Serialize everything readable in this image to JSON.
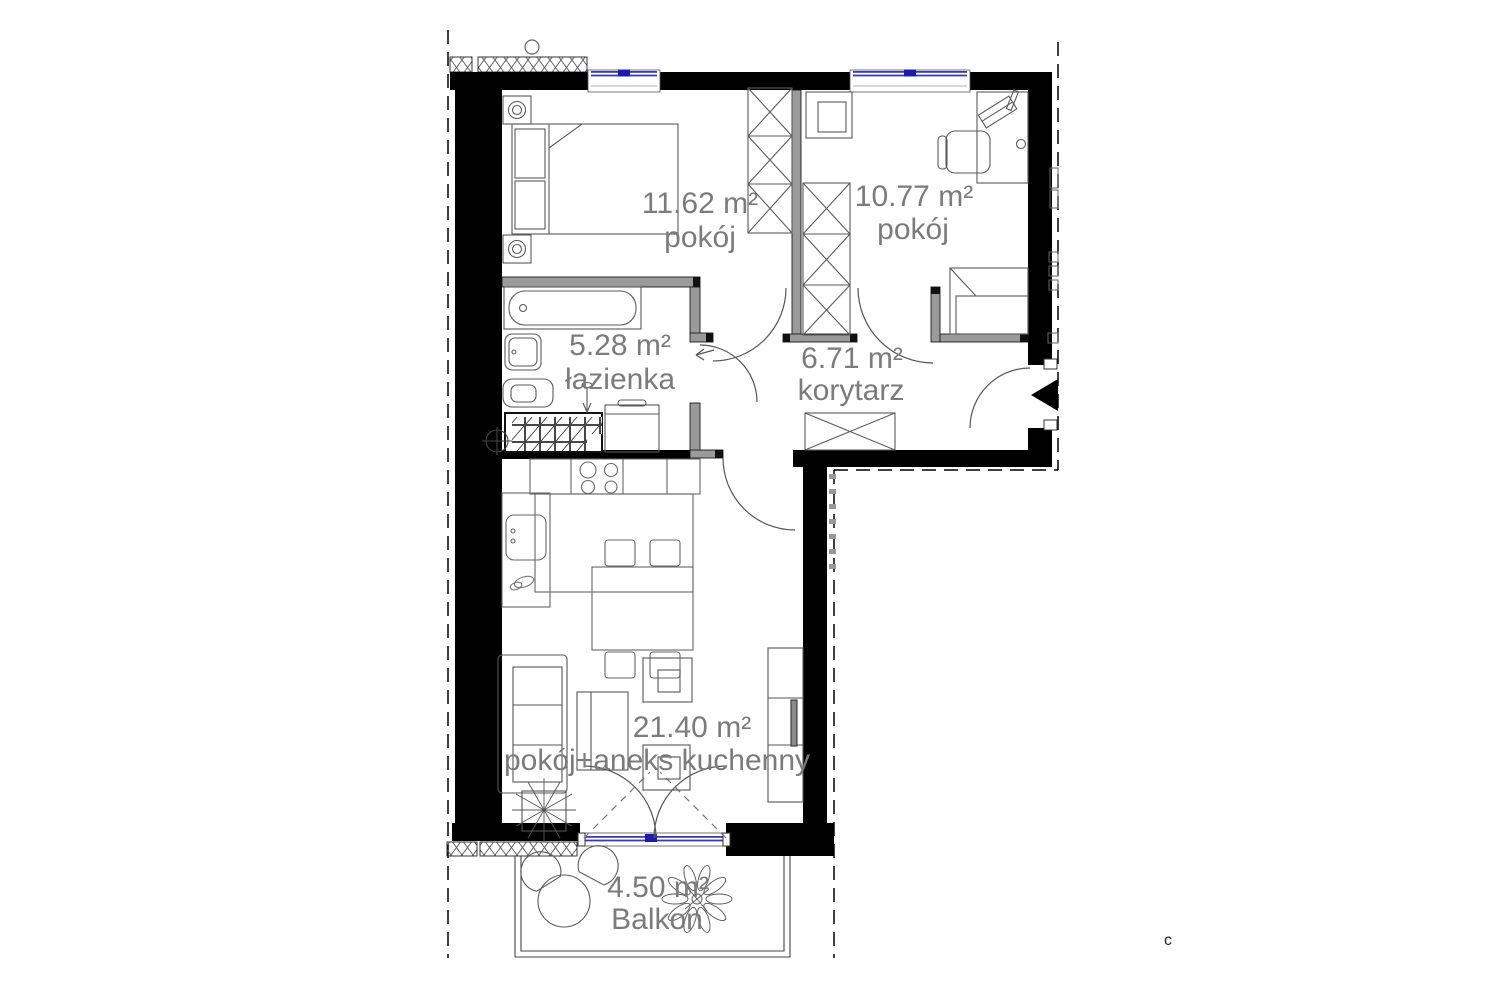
{
  "plan": {
    "type": "apartment-floor-plan",
    "rooms": {
      "bedroom": {
        "area": "11.62 m²",
        "name": "pokój"
      },
      "office": {
        "area": "10.77 m²",
        "name": "pokój"
      },
      "bathroom": {
        "area": "5.28 m²",
        "name": "łazienka"
      },
      "corridor": {
        "area": "6.71 m²",
        "name": "korytarz"
      },
      "living": {
        "area": "21.40 m²",
        "name": "pokój+aneks kuchenny"
      },
      "balcony": {
        "area": "4.50 m²",
        "name": "Balkon"
      }
    },
    "annotation": "c",
    "colors": {
      "background": "#ffffff",
      "exterior_wall": "#000000",
      "interior_wall": "#9a9a9a",
      "window_glass": "#3a3ab8",
      "window_marker": "#1b1bb0",
      "label_text": "#7b7b7b",
      "furniture_line": "#5a5a5a",
      "hatch_line": "#555555"
    }
  }
}
